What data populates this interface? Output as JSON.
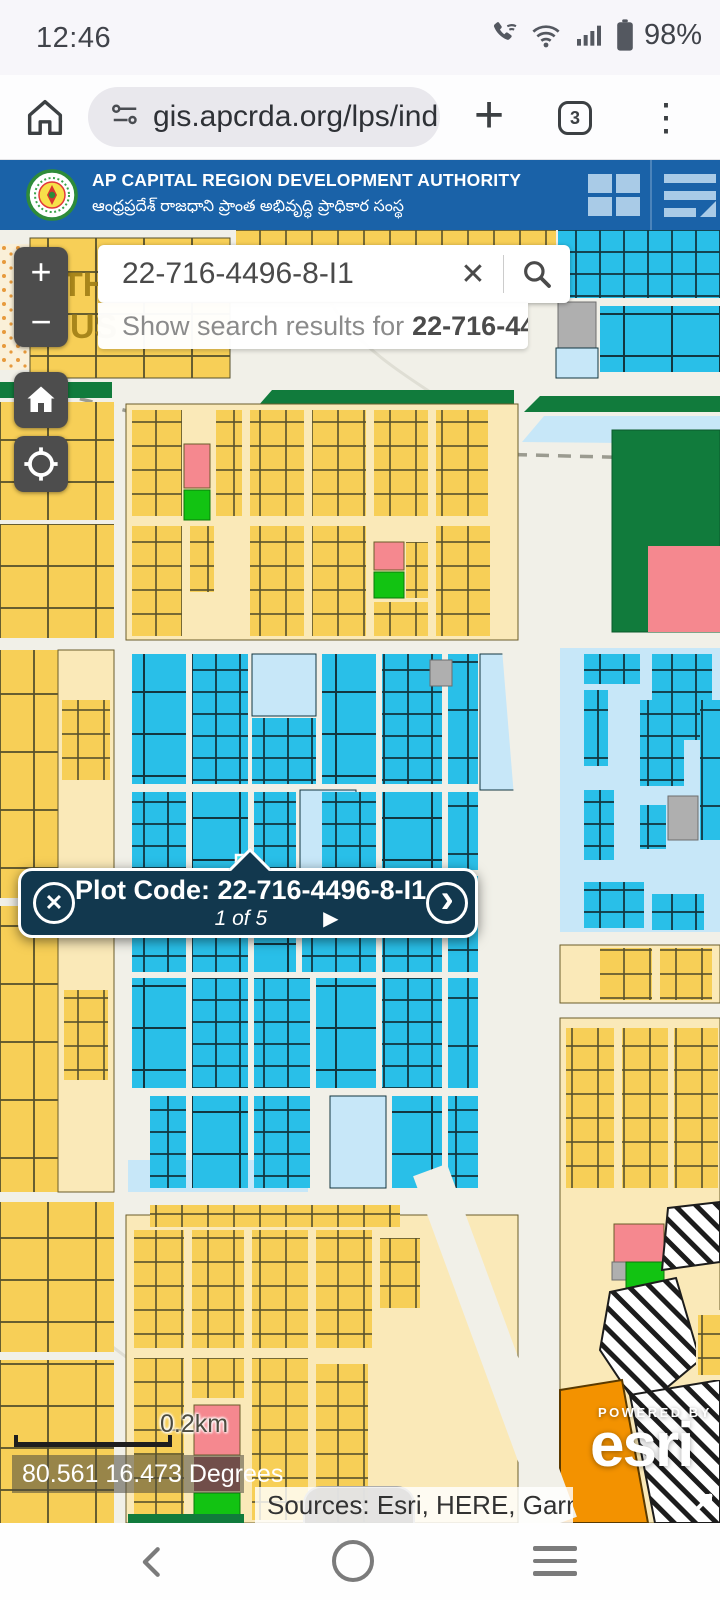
{
  "status_bar": {
    "time": "12:46",
    "battery_percent": "98%"
  },
  "browser_bar": {
    "url": "gis.apcrda.org/lps/ind",
    "tab_count": "3",
    "plus_glyph": "+",
    "kebab_glyph": "⋮"
  },
  "header": {
    "title": "AP CAPITAL REGION DEVELOPMENT AUTHORITY",
    "subtitle_telugu": "ఆంధ్రప్రదేశ్ రాజధాని ప్రాంత అభివృద్ధి ప్రాధికార సంస్థ"
  },
  "map": {
    "search": {
      "query": "22-716-4496-8-I1",
      "clear_glyph": "✕",
      "suggestion_prefix": "Show search results for",
      "suggestion_query": "22-716-449…"
    },
    "zoom": {
      "in": "+",
      "out": "−"
    },
    "popup": {
      "title": "Plot Code: 22-716-4496-8-I1",
      "pager": "1 of 5",
      "play_glyph": "▶",
      "next_glyph": "›",
      "close_glyph": "✕"
    },
    "scale_label": "0.2km",
    "coordinates": "80.561 16.473 Degrees",
    "attribution": "Sources: Esri, HERE, Garm…",
    "attribution_handle_glyph": "▲",
    "powered_by": "POWERED BY",
    "esri_logo": "esri",
    "partial_labels": {
      "a": "TH",
      "b": "US"
    },
    "colors": {
      "header_blue": "#1A62A8",
      "road": "#F1F0E8",
      "plot_yellow": "#F7CF57",
      "plot_pale_yellow": "#FAE9B8",
      "plot_cyan": "#29BFE8",
      "plot_light_blue": "#C7E7F8",
      "open_space_green": "#117B3C",
      "plot_green": "#12C312",
      "plot_pink": "#F5888F",
      "plot_orange": "#F39200",
      "plot_gray": "#AFAFAF",
      "selected_plot": "#3FE3EE",
      "popup_bg": "#12384E"
    }
  }
}
